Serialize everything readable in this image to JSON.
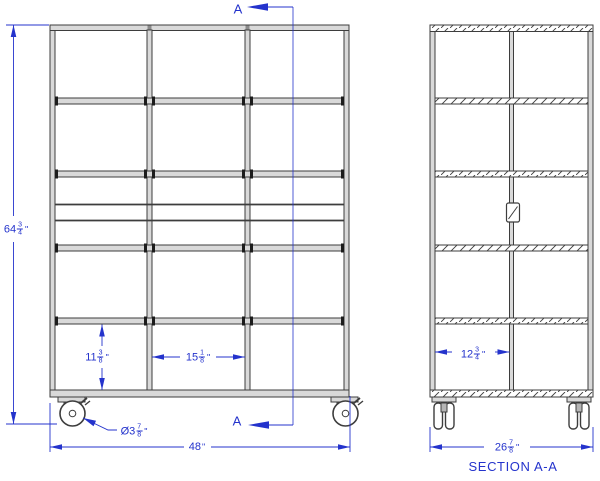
{
  "labels": {
    "overall_height": {
      "whole": "64",
      "num": "3",
      "den": "4",
      "unit": "\""
    },
    "shelf_opening_height": {
      "whole": "11",
      "num": "3",
      "den": "8",
      "unit": "\""
    },
    "bay_opening_width": {
      "whole": "15",
      "num": "1",
      "den": "8",
      "unit": "\""
    },
    "caster_diameter": {
      "prefix": "Ø3",
      "num": "7",
      "den": "8",
      "unit": "\""
    },
    "overall_width": {
      "whole": "48",
      "unit": "\""
    },
    "section_opening_width": {
      "whole": "12",
      "num": "3",
      "den": "4",
      "unit": "\""
    },
    "overall_depth": {
      "whole": "26",
      "num": "7",
      "den": "8",
      "unit": "\""
    },
    "section_cut": "A",
    "section_title": "SECTION A-A"
  },
  "colors": {
    "dimension_blue": "#2433cc",
    "drawing_line": "#3d3d3d",
    "panel_fill": "#d9d9d9"
  }
}
